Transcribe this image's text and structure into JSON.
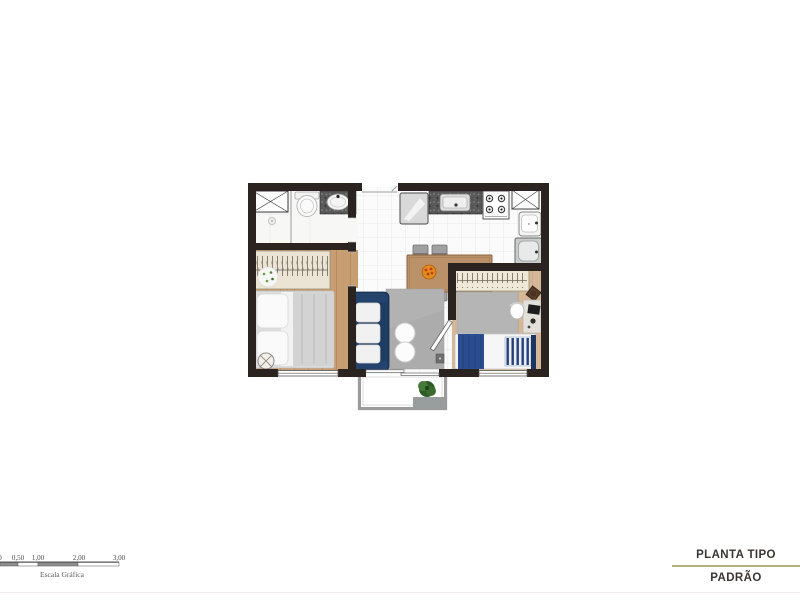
{
  "scale_bar": {
    "labels": [
      "0",
      "0,50",
      "1,00",
      "2,00",
      "3,00"
    ],
    "caption": "Escala Gráfica"
  },
  "title_block": {
    "title": "PLANTA TIPO",
    "subtitle": "PADRÃO",
    "divider_color": "#b3b378"
  },
  "colors": {
    "wall": "#2a2320",
    "wood_floor": "#c79d72",
    "tile_floor": "#ffffff",
    "sofa_navy": "#1f3c63",
    "living_rug": "#acacac",
    "dining_table": "#ba9169",
    "granite_counter": "#585858",
    "bed_blanket_blue": "#2b4e92",
    "wardrobe_cream": "#ebe4d4",
    "balcony_rail": "#9b9b9b",
    "plant_green": "#2e5a28",
    "accent_divider": "#b3b378"
  },
  "floor_plan": {
    "rooms": [
      "bathroom",
      "bedroom-1",
      "living-dining",
      "kitchen",
      "service-area",
      "bedroom-2",
      "balcony"
    ],
    "fixtures": [
      "shower",
      "toilet",
      "bathroom-sink",
      "fridge",
      "kitchen-sink",
      "stove",
      "overhead-cabinet",
      "service-sink",
      "laundry-tank",
      "dining-table",
      "dining-chairs",
      "fruit-bowl",
      "sofa",
      "pouf-tables",
      "living-rug",
      "double-bed",
      "wardrobe",
      "round-rug",
      "ceiling-fan-symbol",
      "single-bed",
      "desk",
      "desk-chair",
      "balcony-plant",
      "balcony-mat"
    ]
  }
}
